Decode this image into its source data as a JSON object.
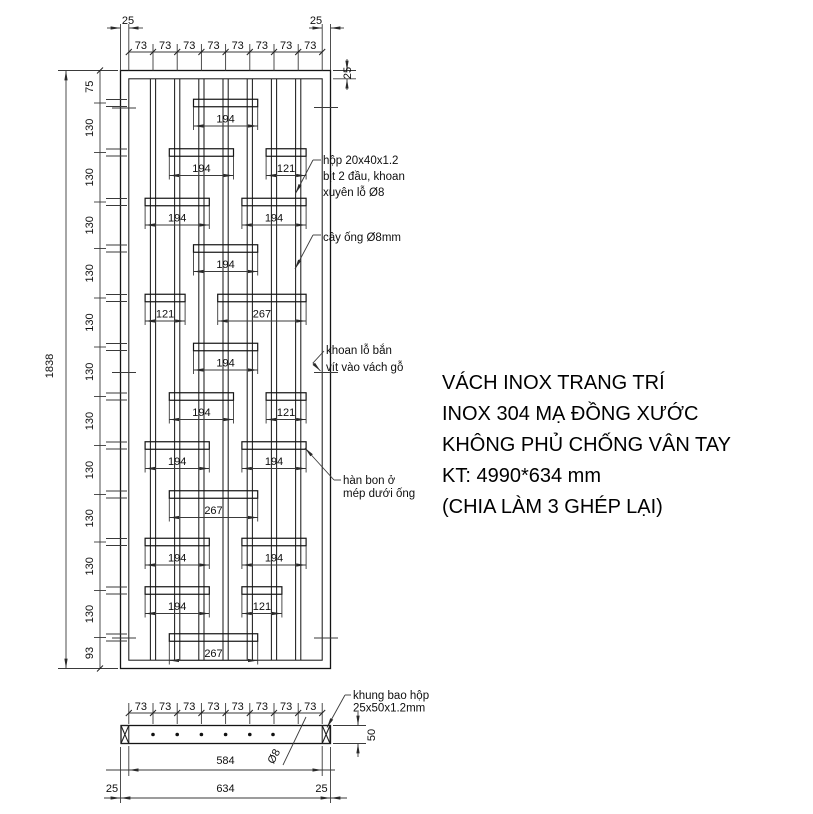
{
  "drawing": {
    "title_block": {
      "lines": [
        "VÁCH INOX TRANG TRÍ",
        "INOX 304 MẠ ĐỒNG XƯỚC",
        "KHÔNG PHỦ CHỐNG VÂN TAY",
        "KT: 4990*634 mm",
        "(CHIA LÀM 3 GHÉP LẠI)"
      ]
    },
    "front_view": {
      "overall_height": "1838",
      "top_left_margin": "25",
      "top_right_margin": "25",
      "frame_thickness": "25",
      "top_chain": [
        "73",
        "73",
        "73",
        "73",
        "73",
        "73",
        "73",
        "73"
      ],
      "left_chain": [
        "75",
        "130",
        "130",
        "130",
        "130",
        "130",
        "130",
        "130",
        "130",
        "130",
        "130",
        "130",
        "93"
      ],
      "bar_dims": [
        "194",
        "194",
        "121",
        "194",
        "194",
        "194",
        "121",
        "267",
        "194",
        "194",
        "121",
        "194",
        "194",
        "267",
        "194",
        "194",
        "194",
        "121",
        "267"
      ]
    },
    "annotations": {
      "hop_tube": [
        "hộp 20x40x1.2",
        "bịt 2 đầu, khoan",
        "xuyên lỗ Ø8"
      ],
      "rod": "cây ống Ø8mm",
      "screw_hole": [
        "khoan lỗ bắn",
        "vít vào vách gỗ"
      ],
      "weld": [
        "hàn bon ở",
        "mép dưới ống"
      ],
      "frame_box": [
        "khung bao hộp",
        "25x50x1.2mm"
      ]
    },
    "section_view": {
      "top_chain": [
        "73",
        "73",
        "73",
        "73",
        "73",
        "73",
        "73",
        "73"
      ],
      "inner_width": "584",
      "outer_width": "634",
      "left_end": "25",
      "right_end": "25",
      "height": "50",
      "rod_dia": "Ø8"
    }
  }
}
